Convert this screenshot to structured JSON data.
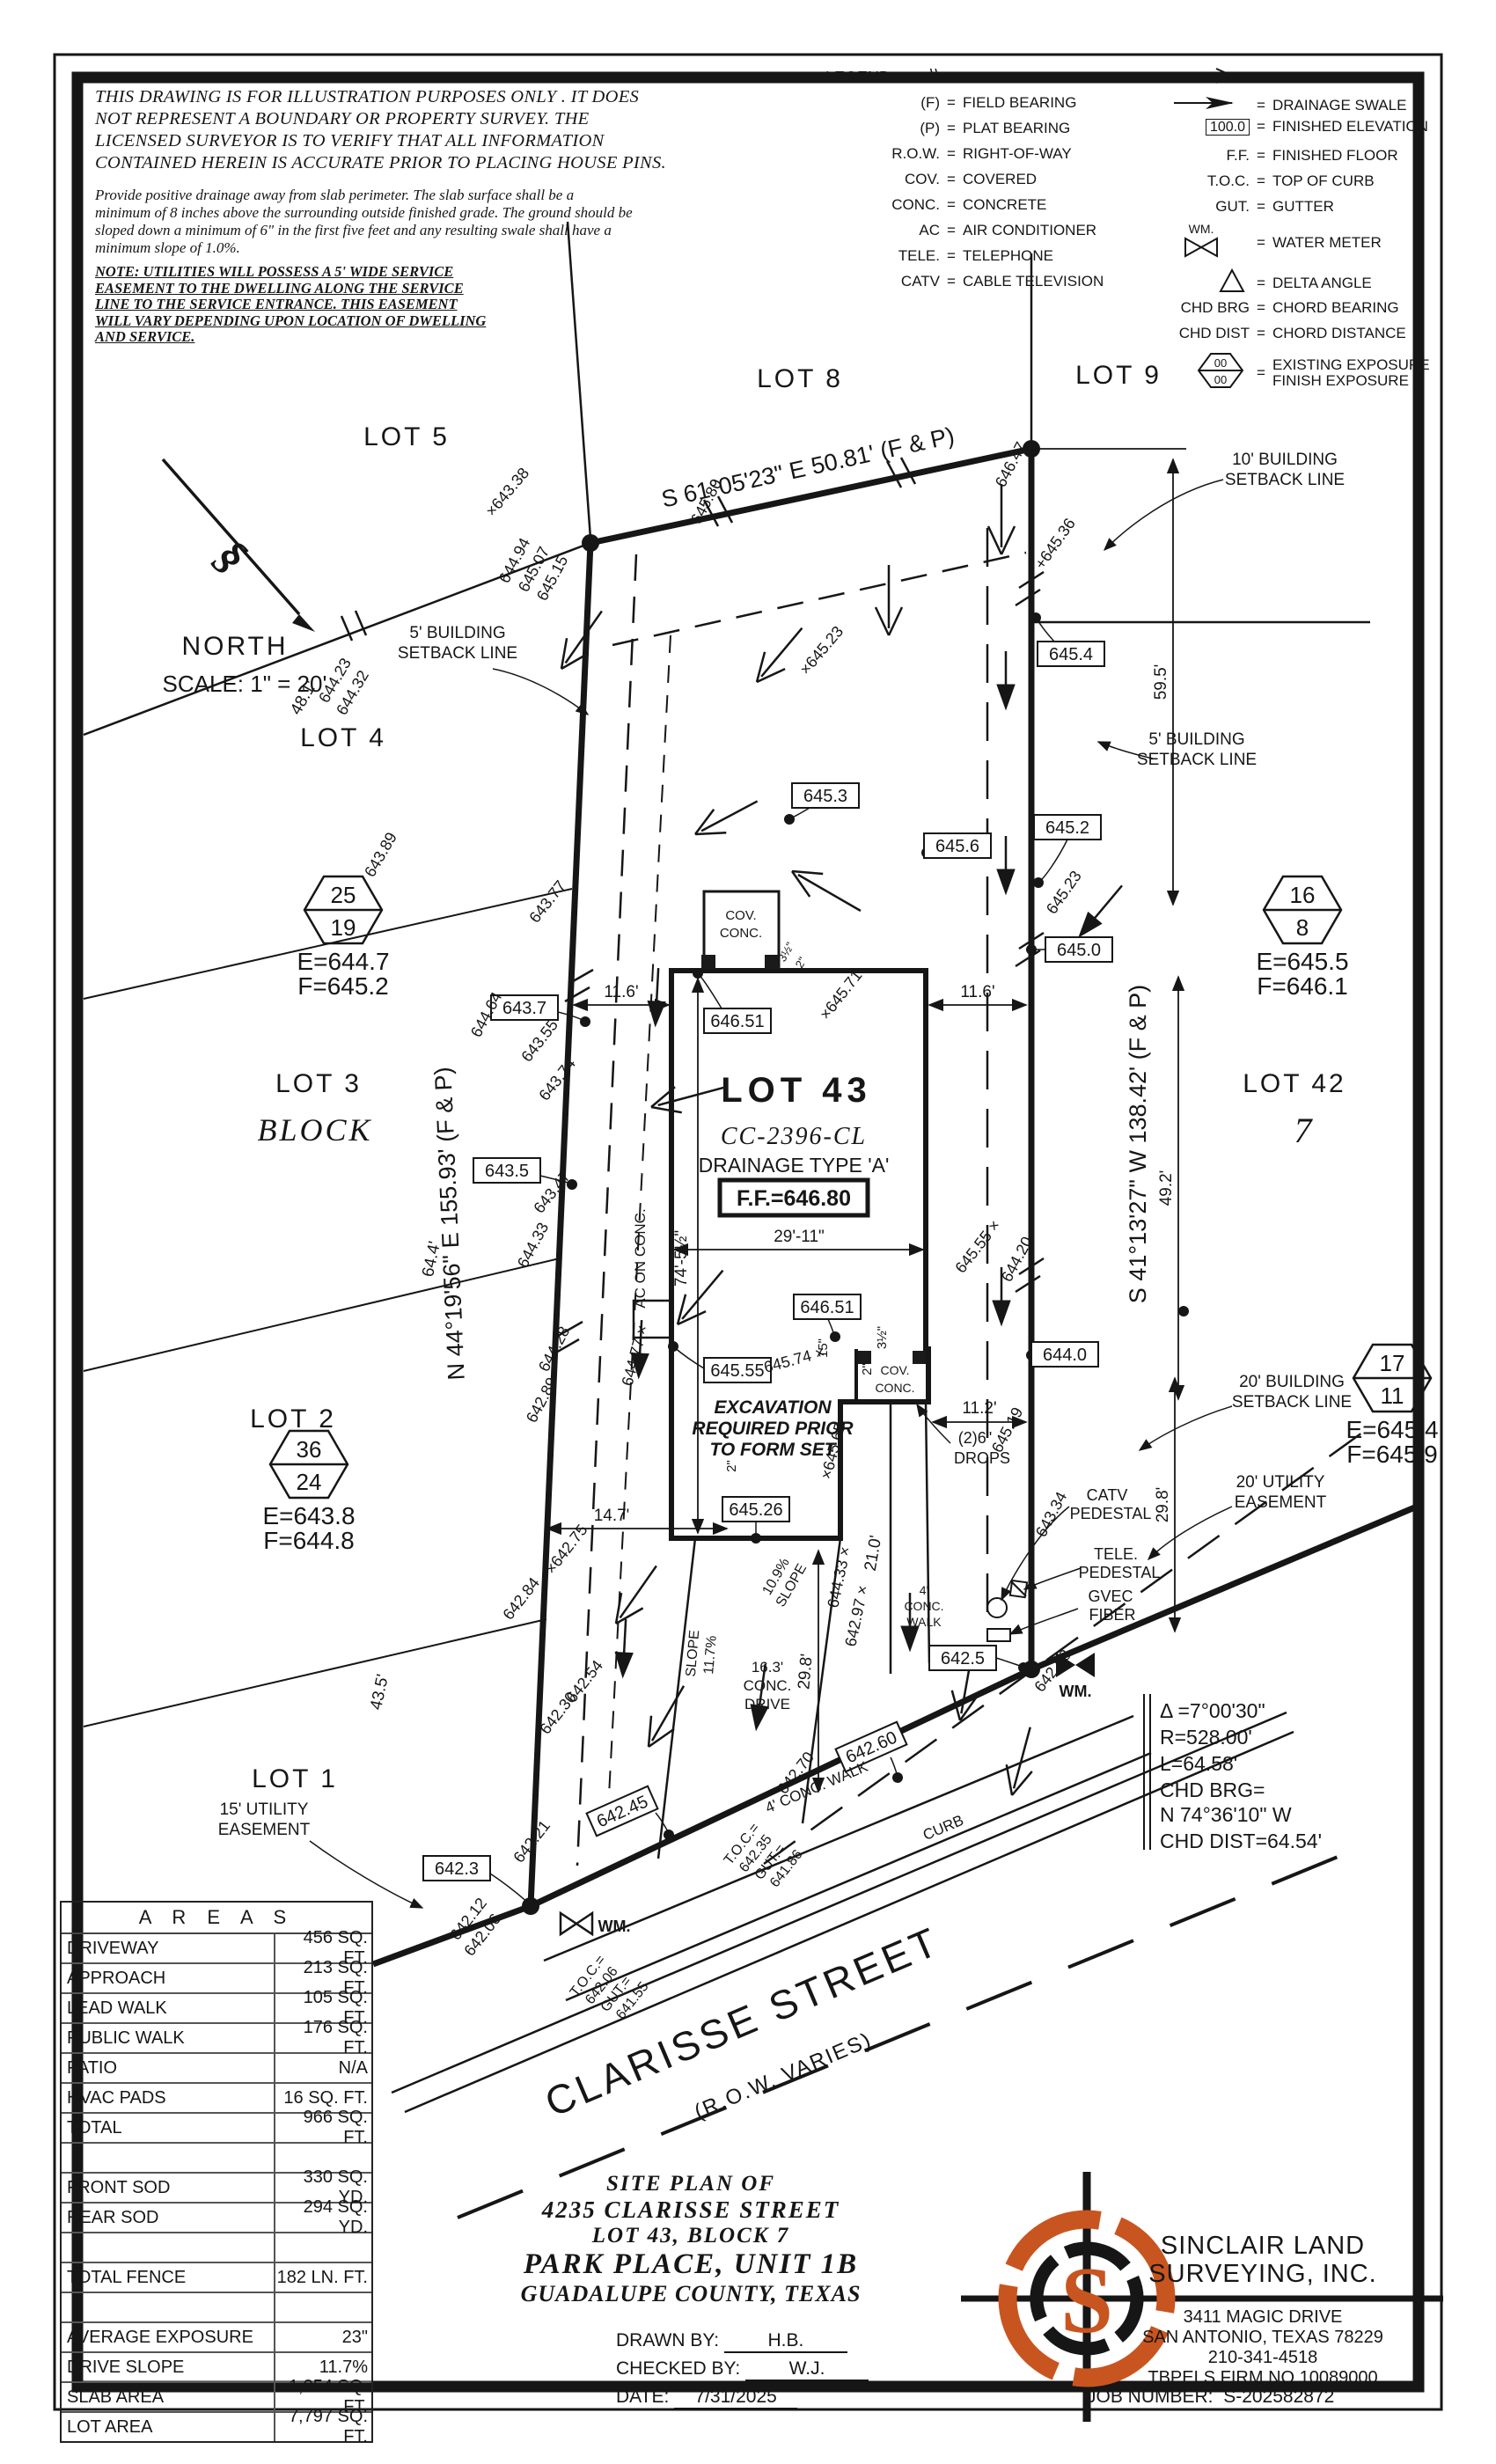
{
  "colors": {
    "ink": "#161616",
    "accent_orange": "#C8551F",
    "grid": "#555555"
  },
  "disclaimer": {
    "lines": [
      "THIS DRAWING IS FOR ILLUSTRATION PURPOSES ONLY . IT DOES",
      "NOT REPRESENT A BOUNDARY OR PROPERTY SURVEY. THE",
      "LICENSED SURVEYOR IS TO VERIFY THAT ALL INFORMATION",
      "CONTAINED HEREIN IS ACCURATE PRIOR TO PLACING HOUSE PINS."
    ]
  },
  "grading": {
    "lines": [
      "Provide positive drainage away from slab perimeter. The slab surface shall be a",
      "minimum of 8 inches above the surrounding outside finished grade. The ground should be",
      "sloped down a minimum of 6\" in the first five feet and any resulting swale shall have a",
      "minimum slope of 1.0%."
    ]
  },
  "note": {
    "lines": [
      "NOTE:  UTILITIES  WILL  POSSESS  A  5'  WIDE  SERVICE",
      "EASEMENT  TO  THE  DWELLING  ALONG  THE  SERVICE",
      "LINE  TO  THE  SERVICE  ENTRANCE.  THIS  EASEMENT",
      "WILL  VARY  DEPENDING  UPON  LOCATION  OF  DWELLING",
      "AND  SERVICE."
    ]
  },
  "legend": {
    "title": "LEGEND:",
    "eq": "=",
    "left": [
      {
        "sym": "\\\\",
        "label": "WOOD FENCE"
      },
      {
        "sym": "(F)",
        "label": "FIELD BEARING"
      },
      {
        "sym": "(P)",
        "label": "PLAT BEARING"
      },
      {
        "sym": "R.O.W.",
        "label": "RIGHT-OF-WAY"
      },
      {
        "sym": "COV.",
        "label": "COVERED"
      },
      {
        "sym": "CONC.",
        "label": "CONCRETE"
      },
      {
        "sym": "AC",
        "label": "AIR CONDITIONER"
      },
      {
        "sym": "TELE.",
        "label": "TELEPHONE"
      },
      {
        "sym": "CATV",
        "label": "CABLE TELEVISION"
      }
    ],
    "right": [
      {
        "sym": "sheet-flow-arrow",
        "label": "SHEET FLOW"
      },
      {
        "sym": "drainage-swale-arrow",
        "label": "DRAINAGE SWALE"
      },
      {
        "sym": "100.0",
        "label": "FINISHED ELEVATION"
      },
      {
        "sym": "F.F.",
        "label": "FINISHED FLOOR"
      },
      {
        "sym": "T.O.C.",
        "label": "TOP OF CURB"
      },
      {
        "sym": "GUT.",
        "label": "GUTTER"
      },
      {
        "sym": "WM.",
        "label": "WATER METER"
      },
      {
        "sym": "delta-triangle",
        "label": "DELTA ANGLE"
      },
      {
        "sym": "CHD BRG",
        "label": "CHORD BEARING"
      },
      {
        "sym": "CHD DIST",
        "label": "CHORD DISTANCE"
      },
      {
        "sym": "00/00",
        "label": "EXISTING EXPOSURE",
        "label2": "FINISH EXPOSURE"
      }
    ]
  },
  "north": {
    "label": "NORTH",
    "scale": "SCALE:  1\" =  20'"
  },
  "plan": {
    "lots": {
      "lot5": "LOT 5",
      "lot8": "LOT 8",
      "lot9": "LOT 9",
      "lot4": "LOT 4",
      "lot3": "LOT 3",
      "block": "BLOCK",
      "lot2": "LOT 2",
      "lot1": "LOT 1",
      "lot42": "LOT 42",
      "block7": "7"
    },
    "bearings": {
      "top": "S 61°05'23\" E 50.81' (F & P)",
      "left": "N 44°19'56\" E 155.93' (F & P)",
      "right": "S 41°13'27\" W 138.42' (F & P)"
    },
    "building": {
      "lot": "LOT 43",
      "plan_id": "CC-2396-CL",
      "drainage": "DRAINAGE TYPE 'A'",
      "ff": "F.F.=646.80",
      "excavation": [
        "EXCAVATION",
        "REQUIRED PRIOR",
        "TO FORM SET"
      ],
      "cov": [
        "COV.",
        "CONC."
      ],
      "ac": "AC ON CONC."
    },
    "dims": {
      "d116l": "11.6'",
      "d116r": "11.6'",
      "d2911": "29'-11\"",
      "d745": "74'-5½\"",
      "d112": "11.2'",
      "d147": "14.7'",
      "d15": "15\"",
      "d2a": "2\"",
      "d2b": "2\"",
      "d35": "3½\"",
      "d595": "59.5'",
      "d492": "49.2'",
      "d298a": "29.8'",
      "d298b": "29.8'",
      "d210": "21.0'",
      "d481": "48.1'",
      "d644": "64.4'",
      "d435": "43.5'"
    },
    "spots": [
      {
        "v": "×643.38"
      },
      {
        "v": "644.94"
      },
      {
        "v": "645.07"
      },
      {
        "v": "645.15"
      },
      {
        "v": "645.80"
      },
      {
        "v": "646.47"
      },
      {
        "v": "+645.36"
      },
      {
        "v": "×645.23"
      },
      {
        "v": "645.23"
      },
      {
        "v": "644.23"
      },
      {
        "v": "644.32"
      },
      {
        "v": "643.89"
      },
      {
        "v": "643.77"
      },
      {
        "v": "643.55"
      },
      {
        "v": "643.74"
      },
      {
        "v": "644.64"
      },
      {
        "v": "644.33"
      },
      {
        "v": "643.47"
      },
      {
        "v": "644.28"
      },
      {
        "v": "642.89"
      },
      {
        "v": "644.77 ×"
      },
      {
        "v": "×642.75"
      },
      {
        "v": "642.84"
      },
      {
        "v": "642.54"
      },
      {
        "v": "642.30"
      },
      {
        "v": "642.12"
      },
      {
        "v": "642.06"
      },
      {
        "v": "642.21"
      },
      {
        "v": "642.58"
      },
      {
        "v": "643.34"
      },
      {
        "v": "×645.71"
      },
      {
        "v": "645.74 ×"
      },
      {
        "v": "×645.65"
      },
      {
        "v": "645.55 ×"
      },
      {
        "v": "644.20"
      },
      {
        "v": "645.19"
      },
      {
        "v": "644.33 ×"
      },
      {
        "v": "642.97 ×"
      },
      {
        "v": "642.70"
      }
    ],
    "boxes": [
      {
        "v": "645.4"
      },
      {
        "v": "645.2"
      },
      {
        "v": "645.6"
      },
      {
        "v": "645.3"
      },
      {
        "v": "645.0"
      },
      {
        "v": "643.7"
      },
      {
        "v": "643.5"
      },
      {
        "v": "646.51"
      },
      {
        "v": "646.51"
      },
      {
        "v": "645.55"
      },
      {
        "v": "645.26"
      },
      {
        "v": "644.0"
      },
      {
        "v": "642.5"
      },
      {
        "v": "642.3"
      },
      {
        "v": "642.45"
      },
      {
        "v": "642.60"
      }
    ],
    "hexes": [
      {
        "top": "25",
        "bot": "19",
        "e": "E=644.7",
        "f": "F=645.2"
      },
      {
        "top": "16",
        "bot": "8",
        "e": "E=645.5",
        "f": "F=646.1"
      },
      {
        "top": "36",
        "bot": "24",
        "e": "E=643.8",
        "f": "F=644.8"
      },
      {
        "top": "17",
        "bot": "11",
        "e": "E=645.4",
        "f": "F=645.9"
      }
    ],
    "setbacks": {
      "b10": [
        "10' BUILDING",
        "SETBACK LINE"
      ],
      "b5l": [
        "5' BUILDING",
        "SETBACK LINE"
      ],
      "b5r": [
        "5' BUILDING",
        "SETBACK LINE"
      ],
      "b20": [
        "20' BUILDING",
        "SETBACK LINE"
      ],
      "u20": [
        "20' UTILITY",
        "EASEMENT"
      ],
      "u15": [
        "15' UTILITY",
        "EASEMENT"
      ]
    },
    "utilities": {
      "catv": [
        "CATV",
        "PEDESTAL"
      ],
      "tele": [
        "TELE.",
        "PEDESTAL"
      ],
      "gvec": [
        "GVEC",
        "FIBER"
      ],
      "wm": "WM.",
      "drops": [
        "(2)6\"",
        "DROPS"
      ]
    },
    "street": {
      "name": "CLARISSE STREET",
      "row": "(R.O.W. VARIES)",
      "curb": "CURB",
      "walk": "4' CONC. WALK",
      "walk_r": [
        "4'",
        "CONC.",
        "WALK"
      ],
      "drive": [
        "16.3'",
        "CONC.",
        "DRIVE"
      ],
      "slope1": [
        "SLOPE",
        "11.7%"
      ],
      "slope2": [
        "10.9%",
        "SLOPE"
      ],
      "toc1": [
        "T.O.C.=",
        "642.06",
        "GUT.=",
        "641.55"
      ],
      "toc2": [
        "T.O.C.=",
        "642.35",
        "GUT.=",
        "641.86"
      ]
    },
    "curve": {
      "lines": [
        "Δ =7°00'30\"",
        "R=528.00'",
        "L=64.58'",
        "CHD BRG=",
        "N 74°36'10\" W",
        "CHD DIST=64.54'"
      ]
    }
  },
  "areas": {
    "title": "A R E A S",
    "rows": [
      {
        "label": "DRIVEWAY",
        "value": "456 SQ. FT."
      },
      {
        "label": "APPROACH",
        "value": "213 SQ. FT."
      },
      {
        "label": "LEAD WALK",
        "value": "105 SQ. FT."
      },
      {
        "label": "PUBLIC WALK",
        "value": "176 SQ. FT."
      },
      {
        "label": "PATIO",
        "value": "N/A"
      },
      {
        "label": "HVAC PADS",
        "value": "16 SQ. FT."
      },
      {
        "label": "TOTAL",
        "value": "966 SQ. FT."
      },
      {
        "label": "",
        "value": ""
      },
      {
        "label": "FRONT SOD",
        "value": "330 SQ. YD."
      },
      {
        "label": "REAR SOD",
        "value": "294 SQ. YD."
      },
      {
        "label": "",
        "value": ""
      },
      {
        "label": "TOTAL FENCE",
        "value": "182 LN. FT."
      },
      {
        "label": "",
        "value": ""
      },
      {
        "label": "AVERAGE EXPOSURE",
        "value": "23\""
      },
      {
        "label": "DRIVE SLOPE",
        "value": "11.7%"
      },
      {
        "label": "SLAB AREA",
        "value": "1,854 SQ. FT."
      },
      {
        "label": "LOT AREA",
        "value": "7,797 SQ. FT."
      }
    ]
  },
  "title_block": {
    "lines": [
      "SITE  PLAN  OF",
      "4235  CLARISSE  STREET",
      "LOT  43,  BLOCK  7",
      "PARK  PLACE,  UNIT  1B",
      "GUADALUPE  COUNTY,  TEXAS"
    ],
    "drawn_label": "DRAWN BY:",
    "drawn": "H.B.",
    "checked_label": "CHECKED BY:",
    "checked": "W.J.",
    "date_label": "DATE:",
    "date": "7/31/2025"
  },
  "company": {
    "name1": "SINCLAIR LAND",
    "name2": "SURVEYING, INC.",
    "address1": "3411 MAGIC DRIVE",
    "address2": "SAN ANTONIO, TEXAS 78229",
    "phone": "210-341-4518",
    "firm": "TBPELS FIRM NO.10089000",
    "job_label": "JOB NUMBER:",
    "job": "S-202582872",
    "logo_letter": "S"
  }
}
